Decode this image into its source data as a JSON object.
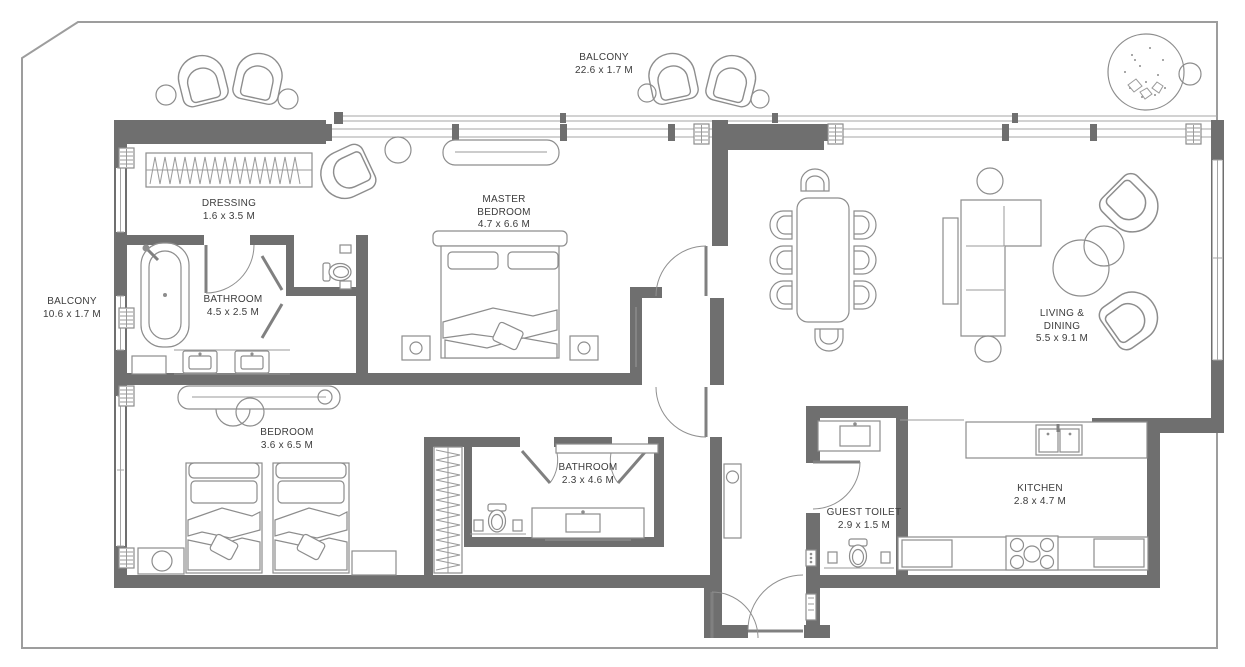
{
  "title": "Apartment floor plan",
  "colors": {
    "wall": "#6f6f6f",
    "furniture_line": "#8d8d8d",
    "boundary": "#9d9d9d",
    "text": "#3c3c3c"
  },
  "rooms": {
    "balcony_top": {
      "name": "BALCONY",
      "dims": "22.6 x 1.7 M"
    },
    "balcony_left": {
      "name": "BALCONY",
      "dims": "10.6 x 1.7 M"
    },
    "dressing": {
      "name": "DRESSING",
      "dims": "1.6 x 3.5 M"
    },
    "master_bedroom": {
      "line1": "MASTER",
      "line2": "BEDROOM",
      "dims": "4.7 x 6.6 M"
    },
    "master_bathroom": {
      "name": "BATHROOM",
      "dims": "4.5 x 2.5 M"
    },
    "living_dining": {
      "line1": "LIVING &",
      "line2": "DINING",
      "dims": "5.5 x 9.1 M"
    },
    "bedroom": {
      "name": "BEDROOM",
      "dims": "3.6 x 6.5 M"
    },
    "bathroom": {
      "name": "BATHROOM",
      "dims": "2.3 x 4.6 M"
    },
    "guest_toilet": {
      "name": "GUEST TOILET",
      "dims": "2.9 x 1.5 M"
    },
    "kitchen": {
      "name": "KITCHEN",
      "dims": "2.8 x 4.7 M"
    }
  }
}
